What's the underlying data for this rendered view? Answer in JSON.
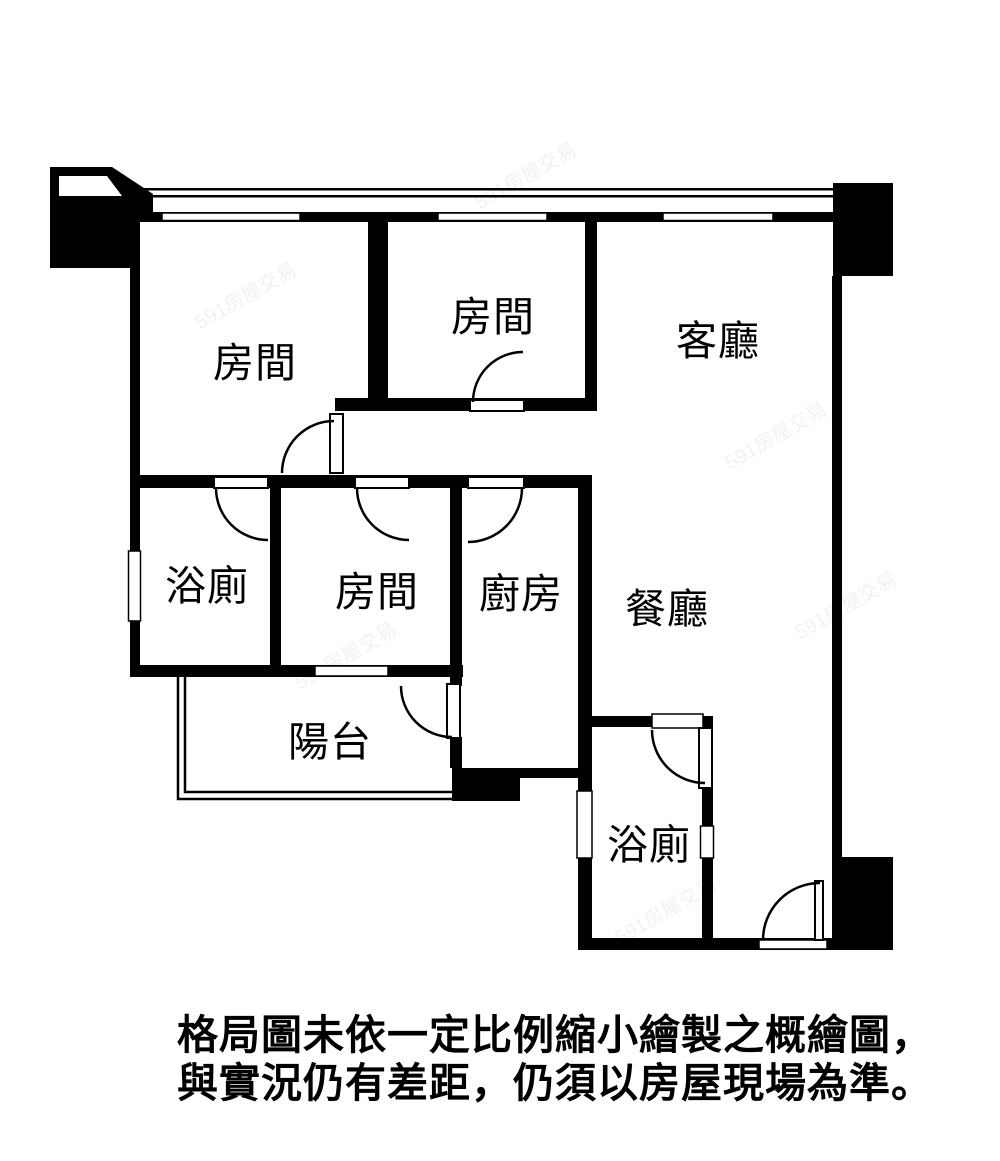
{
  "floor_plan": {
    "rooms": [
      {
        "name": "bedroom-top-left",
        "label": "房間"
      },
      {
        "name": "bedroom-top-middle",
        "label": "房間"
      },
      {
        "name": "living-room",
        "label": "客廳"
      },
      {
        "name": "bathroom-upper",
        "label": "浴廁"
      },
      {
        "name": "bedroom-middle",
        "label": "房間"
      },
      {
        "name": "kitchen",
        "label": "廚房"
      },
      {
        "name": "dining-room",
        "label": "餐廳"
      },
      {
        "name": "balcony",
        "label": "陽台"
      },
      {
        "name": "bathroom-lower",
        "label": "浴廁"
      }
    ]
  },
  "disclaimer": {
    "line1": "格局圖未依一定比例縮小繪製之概繪圖，",
    "line2": "與實況仍有差距，仍須以房屋現場為準。"
  },
  "watermark": {
    "text": "591房屋交易"
  },
  "colors": {
    "wall": "#000000",
    "background": "#ffffff"
  }
}
